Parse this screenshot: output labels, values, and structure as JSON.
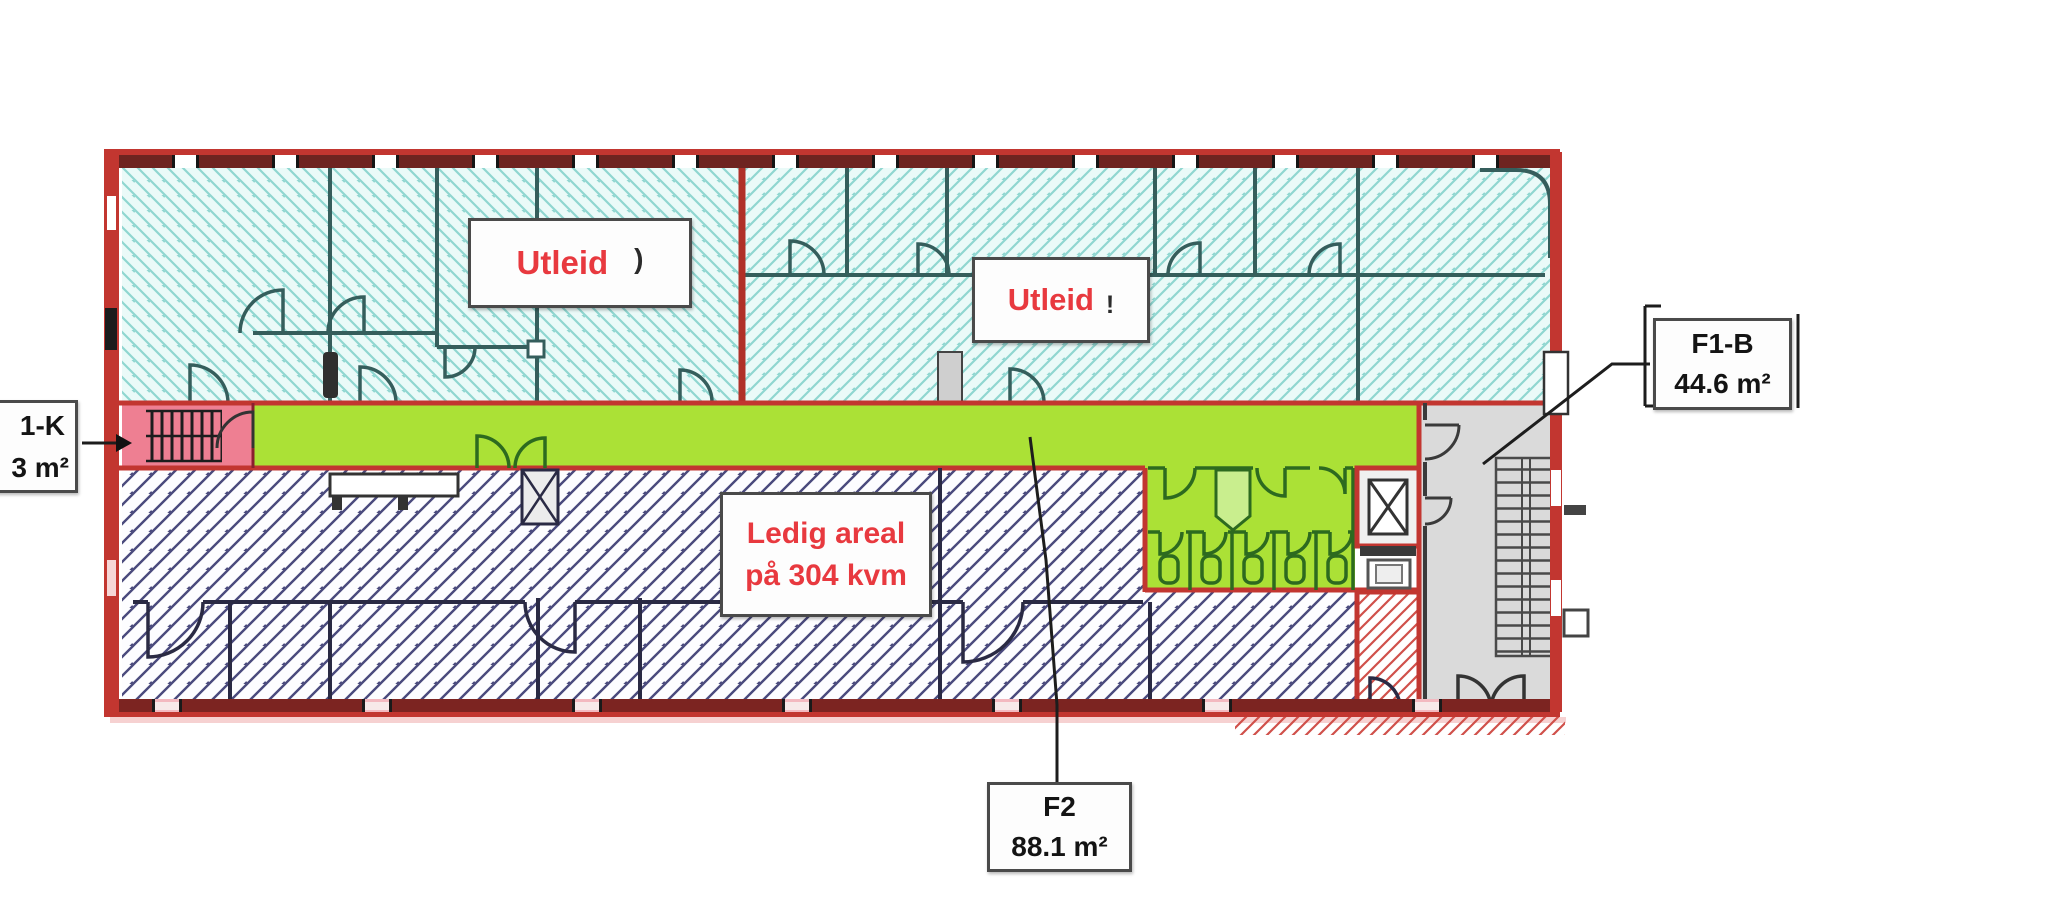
{
  "labels": {
    "utleid_1": {
      "text": "Utleid",
      "mark": ")"
    },
    "utleid_2": {
      "text": "Utleid",
      "mark": "!"
    },
    "ledig_areal": {
      "line1": "Ledig areal",
      "line2": "på 304 kvm"
    },
    "f1b": {
      "code": "F1-B",
      "area": "44.6 m²"
    },
    "f2": {
      "code": "F2",
      "area": "88.1 m²"
    },
    "f1k_partial": {
      "code": "1-K",
      "area": "3 m²"
    }
  },
  "colors": {
    "wall_red": "#c23630",
    "maroon_window_band": "#6e2420",
    "wall_teal": "#355e5c",
    "wall_dark_navy": "#2a2a44",
    "hatch_cyan": "#8fd6d0",
    "hatch_navy": "#4a4a7d",
    "hatch_red": "#d0504a",
    "corridor_green": "#abe136",
    "toilet_fixture_green": "#2d6a1f",
    "stair_room_pink": "#ee7f92",
    "stairwell_gray": "#dadada",
    "cyan_room_bg": "#eafaf8",
    "label_text_red": "#e8393f",
    "label_border_gray": "#4a4a4a"
  }
}
